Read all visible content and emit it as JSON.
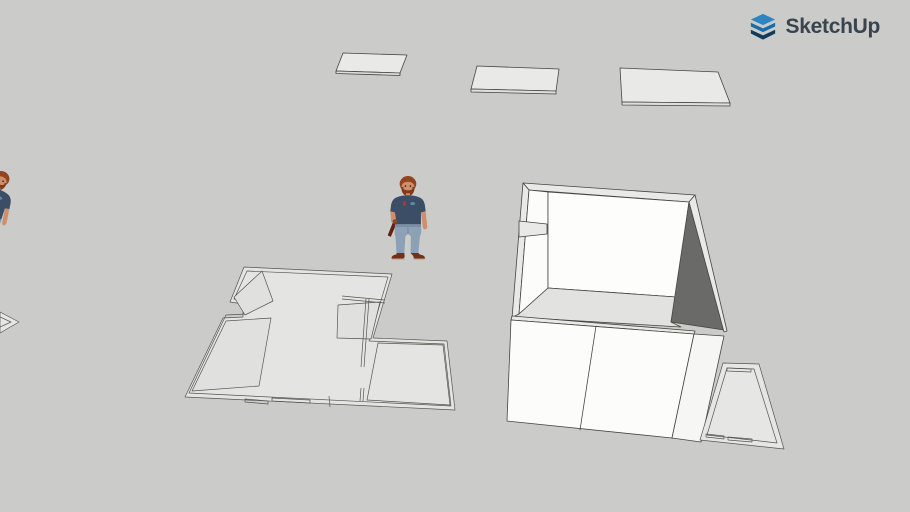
{
  "brand": {
    "text": "SketchUp",
    "logo_color_blue": "#1a6ca8",
    "logo_color_mid_blue": "#2f85c2",
    "logo_color_dark": "#123a5c",
    "text_color": "#39444e"
  },
  "canvas": {
    "background_color": "#cbcbc9",
    "edge_color": "#45463f",
    "face_white": "#fcfcfb",
    "face_white_side": "#f6f6f4",
    "face_wall_top": "#e9e9e7",
    "face_shadow_dark": "#6a6a68",
    "face_floor": "#e2e2e0",
    "plan_fill": "#e4e4e2",
    "plan_room_fill": "#e0e0de",
    "panel_fill": "#e9e9e7",
    "panel_edge_fill": "#dededc"
  },
  "figure": {
    "shirt_color": "#3c4e66",
    "jeans_color": "#8ca0b6",
    "skin_color": "#ce8f6c",
    "hair_color": "#93451f",
    "beard_color": "#7e3a18",
    "shoe_color": "#70301a",
    "tool_color": "#5f2314",
    "chest_graphic_red": "#b5342c",
    "chest_graphic_blue": "#5f87a8"
  },
  "scene": {
    "objects": [
      {
        "label": "flat rectangular panel 1"
      },
      {
        "label": "flat rectangular panel 2"
      },
      {
        "label": "flat rectangular panel 3"
      },
      {
        "label": "scale figure person, partially off-screen left"
      },
      {
        "label": "scale figure person, standing center"
      },
      {
        "label": "flat 2D floor plan laid on ground"
      },
      {
        "label": "3D room volume with walls and interior"
      },
      {
        "label": "flat plan fragment lower right"
      },
      {
        "label": "flat panel corner at left screen edge"
      }
    ]
  }
}
